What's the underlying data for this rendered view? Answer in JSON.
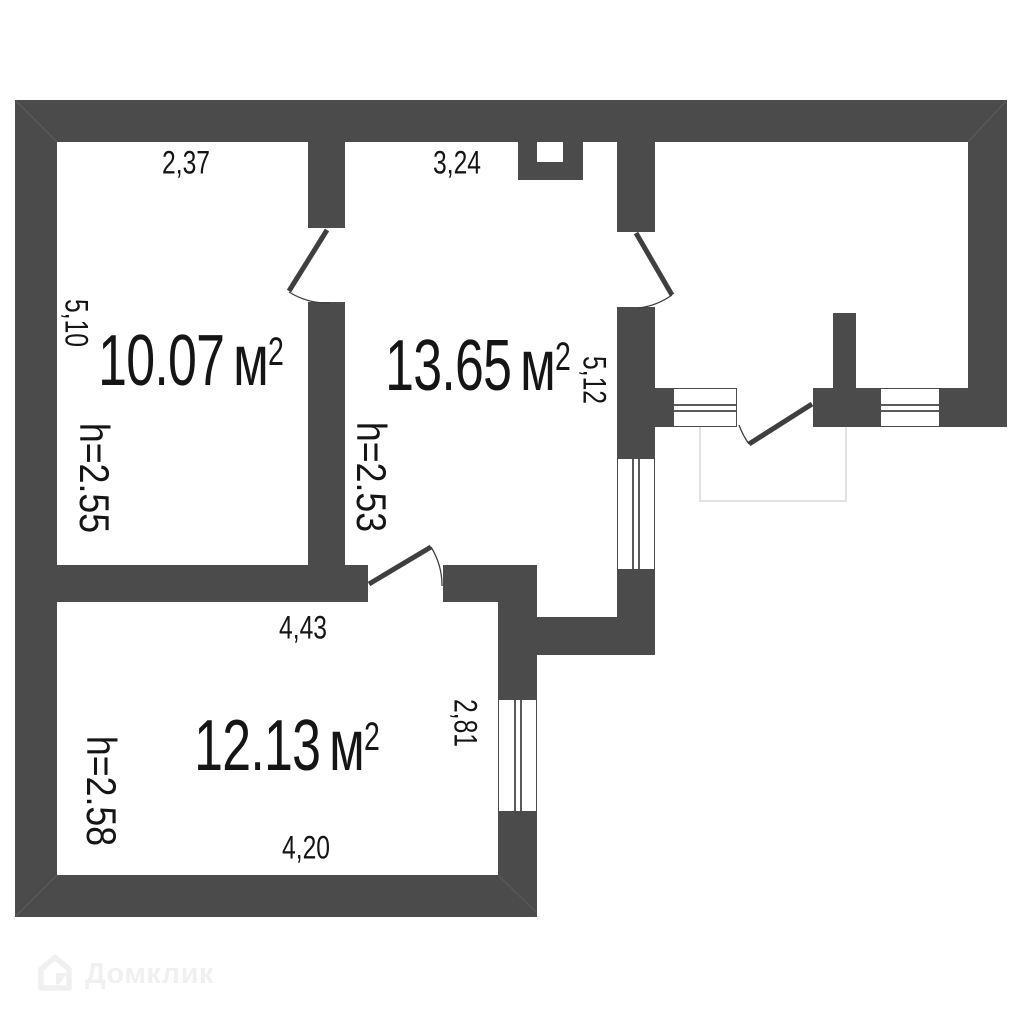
{
  "plan": {
    "type": "floor-plan",
    "rooms": [
      {
        "name": "room-top-left",
        "area": "10.07",
        "ceiling": "h=2.55",
        "dim_top": "2,37",
        "dim_left": "5,10"
      },
      {
        "name": "room-top-middle",
        "area": "13.65",
        "ceiling": "h=2.53",
        "dim_top": "3,24",
        "dim_right": "5,12"
      },
      {
        "name": "room-bottom-left",
        "area": "12.13",
        "ceiling": "h=2.58",
        "dim_top": "4,43",
        "dim_bottom": "4,20",
        "dim_right": "2,81"
      }
    ],
    "units": {
      "area_unit": "м",
      "area_power": "2"
    }
  },
  "watermark": {
    "brand": "Домклик"
  },
  "colors": {
    "wall": "#4b4b4b",
    "text": "#151515",
    "door_line": "#3f3f3f",
    "window_line": "#5a5a5a",
    "balcony_outline": "#e2e2e2",
    "watermark": "#f0f0f0",
    "background": "#ffffff"
  }
}
